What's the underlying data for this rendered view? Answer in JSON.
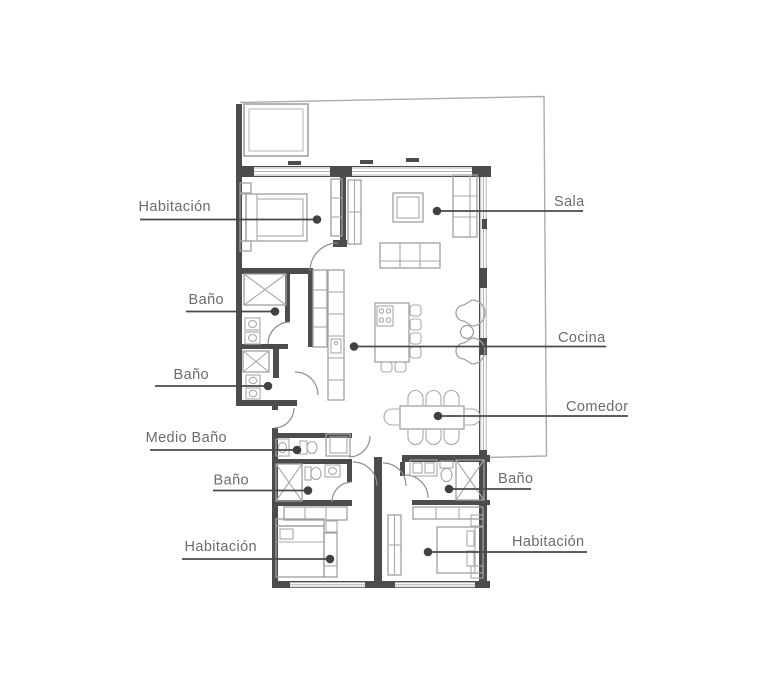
{
  "title": "Floor plan",
  "colors": {
    "background": "#ffffff",
    "wall": "#4c4c4e",
    "furniture_line": "#9fa0a2",
    "window_line": "#b2b2b4",
    "lot_line": "#acacae",
    "label_text": "#6b6b6b",
    "leader_line": "#4a4a4c",
    "leader_dot": "#414143"
  },
  "labels": [
    {
      "room": "bedroom-upper-left",
      "text": "Habitación"
    },
    {
      "room": "bathroom-upper-1",
      "text": "Baño"
    },
    {
      "room": "bathroom-upper-2",
      "text": "Baño"
    },
    {
      "room": "half-bathroom",
      "text": "Medio Baño"
    },
    {
      "room": "bathroom-lower-left",
      "text": "Baño"
    },
    {
      "room": "bedroom-lower-left",
      "text": "Habitación"
    },
    {
      "room": "living-room",
      "text": "Sala"
    },
    {
      "room": "kitchen",
      "text": "Cocina"
    },
    {
      "room": "dining-room",
      "text": "Comedor"
    },
    {
      "room": "bathroom-lower-right",
      "text": "Baño"
    },
    {
      "room": "bedroom-lower-right",
      "text": "Habitación"
    }
  ]
}
